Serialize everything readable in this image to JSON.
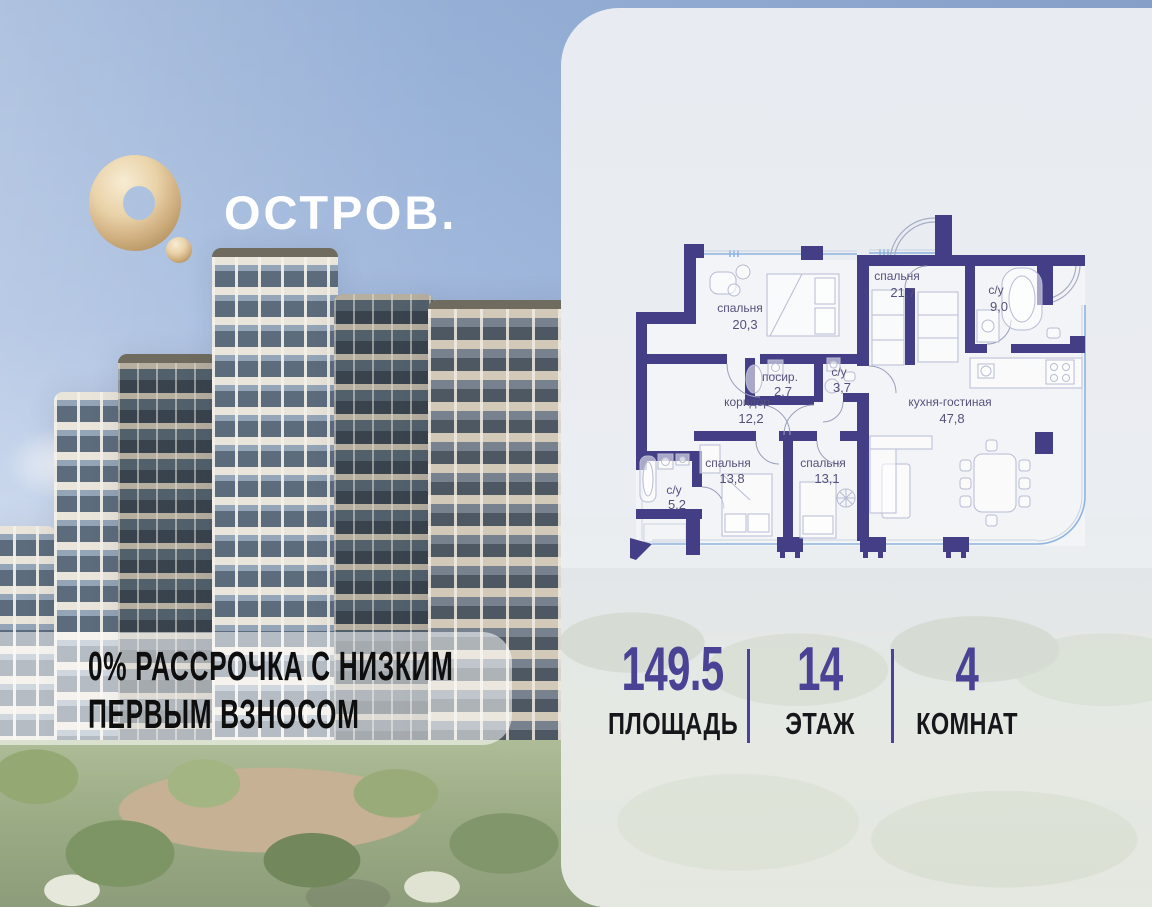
{
  "brand": {
    "logo_text": "ОСТРОВ."
  },
  "promo": {
    "line1": "0% РАССРОЧКА С НИЗКИМ",
    "line2": "ПЕРВЫМ ВЗНОСОМ"
  },
  "floor_plan": {
    "rooms": [
      {
        "name": "спальня",
        "area": "20,3"
      },
      {
        "name": "спальня",
        "area": "21,7"
      },
      {
        "name": "с/у",
        "area": "9,0"
      },
      {
        "name": "посир.",
        "area": "2,7"
      },
      {
        "name": "с/у",
        "area": "3,7"
      },
      {
        "name": "коридор",
        "area": "12,2"
      },
      {
        "name": "кухня-гостиная",
        "area": "47,8"
      },
      {
        "name": "спальня",
        "area": "13,8"
      },
      {
        "name": "спальня",
        "area": "13,1"
      },
      {
        "name": "с/у",
        "area": "5,2"
      }
    ]
  },
  "stats": {
    "items": [
      {
        "value": "149.5",
        "label": "ПЛОЩАДЬ"
      },
      {
        "value": "14",
        "label": "ЭТАЖ"
      },
      {
        "value": "4",
        "label": "КОМНАТ"
      }
    ]
  },
  "colors": {
    "accent_purple": "#4a4294",
    "wall_purple": "#443e86",
    "gold": "#d9bb8c"
  }
}
